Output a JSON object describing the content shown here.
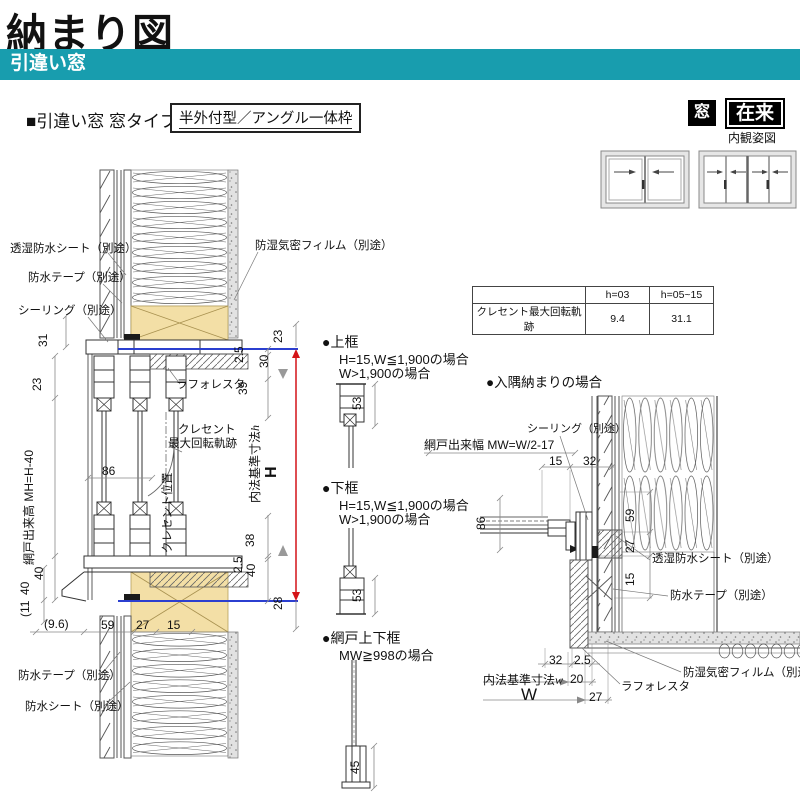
{
  "page": {
    "title": "納まり図",
    "category": "引違い窓"
  },
  "section": {
    "heading": "■引違い窓 窓タイプ",
    "type_label": "半外付型／アングル一体枠"
  },
  "tags": {
    "window": "窓",
    "construction": "在来",
    "caption": "内観姿図"
  },
  "crescent_table": {
    "col_headers": [
      "h=03",
      "h=05~15"
    ],
    "row_label": "クレセント最大回転軌跡",
    "values": [
      "9.4",
      "31.1"
    ]
  },
  "main": {
    "labels": {
      "sheet_top": "透湿防水シート（別途）",
      "tape_top": "防水テープ（別途）",
      "sealing": "シーリング（別途）",
      "film": "防湿気密フィルム（別途）",
      "laforesta": "ラフォレスタ",
      "crescent1": "クレセント",
      "crescent2": "最大回転軌跡",
      "crescent_pos": "クレセント位置",
      "screen_h": "網戸出来高 MH=H-40",
      "inner_dim": "内法基準寸法",
      "inner_dim_sym": "h",
      "h_mark": "H",
      "tape_bottom": "防水テープ（別途）",
      "sheet_bottom": "防水シート（別途）"
    },
    "dims": {
      "l31": "31",
      "a23": "23",
      "a40": "40",
      "s40": "40",
      "s11": "(11",
      "t23": "23",
      "t2_5": "2.5",
      "t30": "30",
      "t39": "39",
      "c86": "86",
      "b38": "38",
      "b2_5": "2.5",
      "b40": "40",
      "b28": "28",
      "f9_6": "(9.6)",
      "f59": "59",
      "f27": "27",
      "f15": "15"
    }
  },
  "mid": {
    "top_rail": {
      "title": "●上框",
      "cond1": "H=15,W≦1,900の場合",
      "cond2": "W>1,900の場合",
      "dim": "53"
    },
    "bottom_rail": {
      "title": "●下框",
      "cond1": "H=15,W≦1,900の場合",
      "cond2": "W>1,900の場合",
      "dim": "53"
    },
    "screen_rail": {
      "title": "●網戸上下框",
      "cond": "MW≧998の場合",
      "dim": "45"
    }
  },
  "corner": {
    "title": "●入隅納まりの場合",
    "labels": {
      "sealing": "シーリング（別途）",
      "screen_width": "網戸出来幅 MW=W/2-17",
      "sheet": "透湿防水シート（別途）",
      "tape": "防水テープ（別途）",
      "film": "防湿気密フィルム（別途）",
      "laforesta": "ラフォレスタ",
      "inner_dim": "内法基準寸法",
      "inner_dim_sym": "w",
      "w_mark": "W"
    },
    "dims": {
      "t15": "15",
      "t32": "32",
      "v86": "86",
      "v59": "59",
      "v27": "27",
      "v15": "15",
      "b32": "32",
      "b2_5": "2.5",
      "b20": "20",
      "b27": "27"
    }
  },
  "colors": {
    "accent_teal": "#189dae",
    "dim_red": "#d41418",
    "datum_blue": "#2b3fd0",
    "wood_tan": "#f3dfa6"
  }
}
